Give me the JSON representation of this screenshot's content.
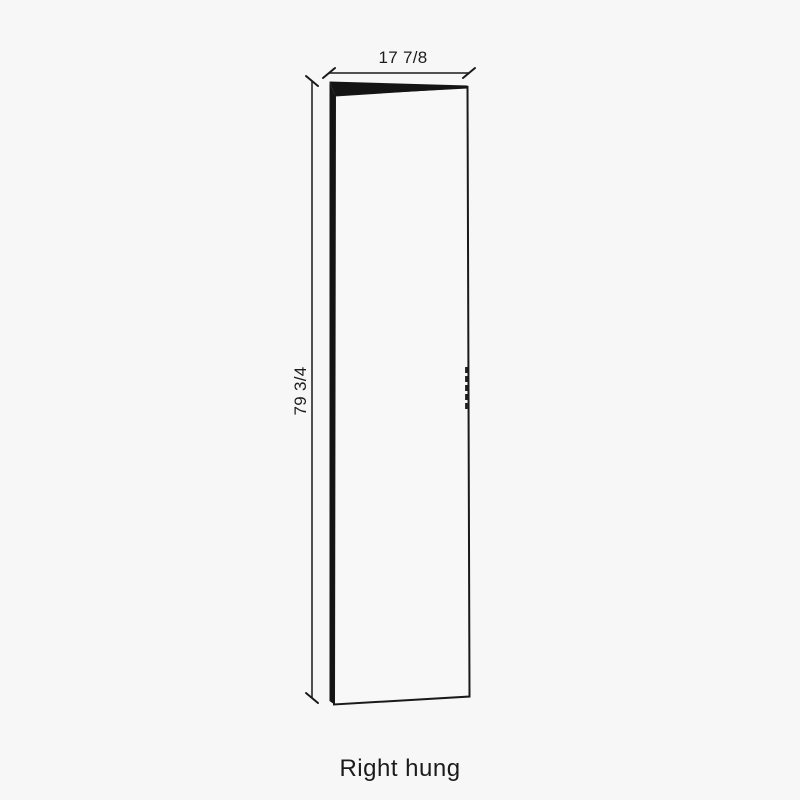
{
  "diagram": {
    "type": "door-front-hinge-diagram",
    "width_label": "17 7/8",
    "height_label": "79 3/4",
    "caption": "Right hung",
    "colors": {
      "background": "#f7f7f7",
      "line": "#1a1a1a",
      "text": "#1c1c1c",
      "door_edge_fill": "#141414",
      "door_face_fill": "#f8f8f8"
    }
  }
}
